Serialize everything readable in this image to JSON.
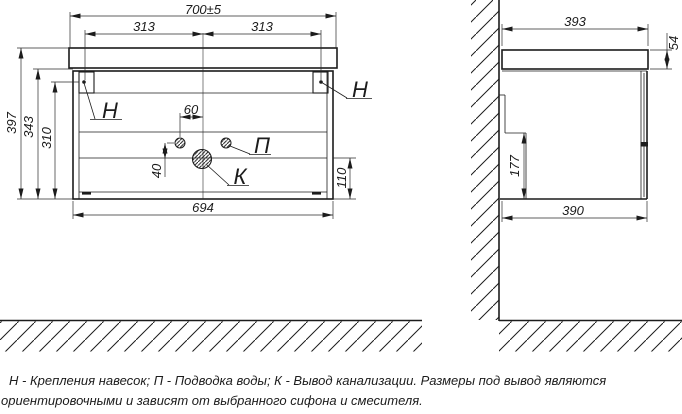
{
  "front_view": {
    "dims": {
      "overall_width": "700±5",
      "left_span": "313",
      "right_span": "313",
      "total_height": "397",
      "body_height": "343",
      "mount_height": "310",
      "bottom_width": "694",
      "drain_zone_height": "110",
      "faucet_spacing": "60",
      "drain_offset": "40"
    },
    "labels": {
      "mount_left": "Н",
      "mount_right": "Н",
      "water": "П",
      "drain": "К"
    }
  },
  "side_view": {
    "dims": {
      "top_depth": "393",
      "countertop_thickness": "54",
      "notch_height": "177",
      "bottom_depth": "390"
    }
  },
  "notes": {
    "line1": "Н - Крепления навесок; П - Подводка воды; К - Вывод канализации. Размеры под вывод являются",
    "line2": "ориентировочными и зависят от выбранного сифона и смесителя."
  },
  "colors": {
    "line": "#1c1c1c",
    "background": "#ffffff"
  }
}
